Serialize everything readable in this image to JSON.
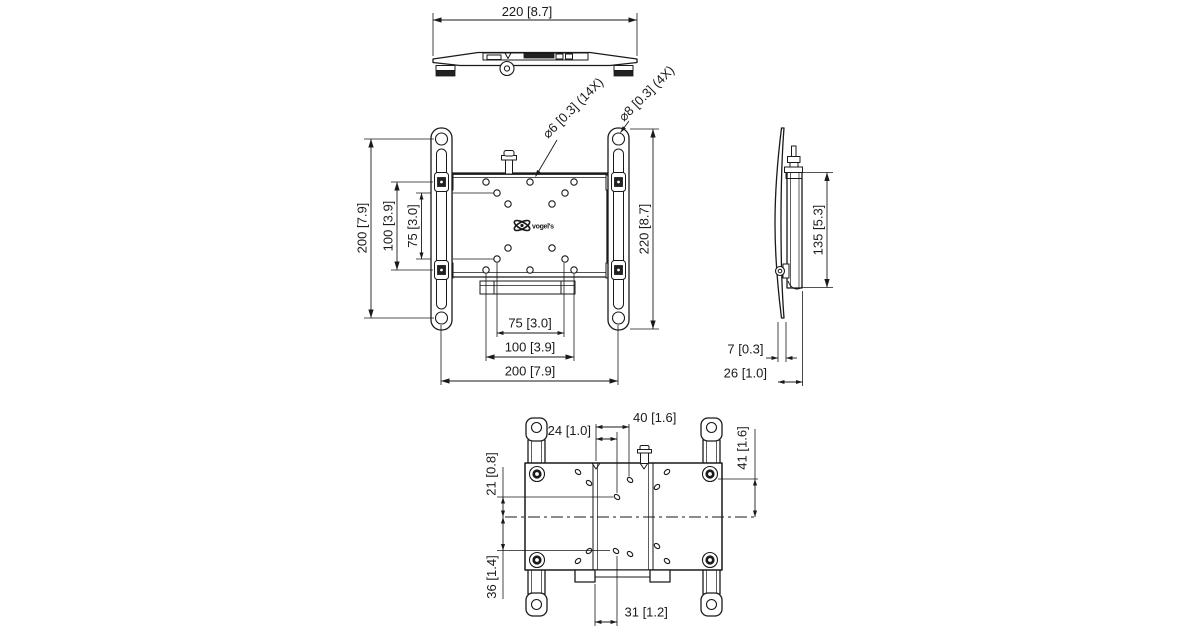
{
  "colors": {
    "line": "#1a1a1a",
    "background": "#ffffff"
  },
  "logo_text": "vogel's",
  "views": {
    "top": {
      "width": "220 [8.7]"
    },
    "front": {
      "left_outer": "200 [7.9]",
      "left_middle": "100 [3.9]",
      "left_inner": "75 [3.0]",
      "right_height": "220 [8.7]",
      "bottom_inner": "75 [3.0]",
      "bottom_middle": "100 [3.9]",
      "bottom_outer": "200 [7.9]",
      "callout_small_holes": "⌀6 [0.3] (14X)",
      "callout_large_holes": "⌀8 [0.3] (4X)"
    },
    "side": {
      "bracket_height": "135 [5.3]",
      "plate_thickness": "7 [0.3]",
      "total_depth": "26 [1.0]"
    },
    "back": {
      "hook_to_screw": "40 [1.6]",
      "hook_to_hole": "24 [1.0]",
      "upper_hole_to_center": "21 [0.8]",
      "top_to_center": "41 [1.6]",
      "center_to_lower_hole": "36 [1.4]",
      "notch_to_hole": "31 [1.2]"
    }
  }
}
